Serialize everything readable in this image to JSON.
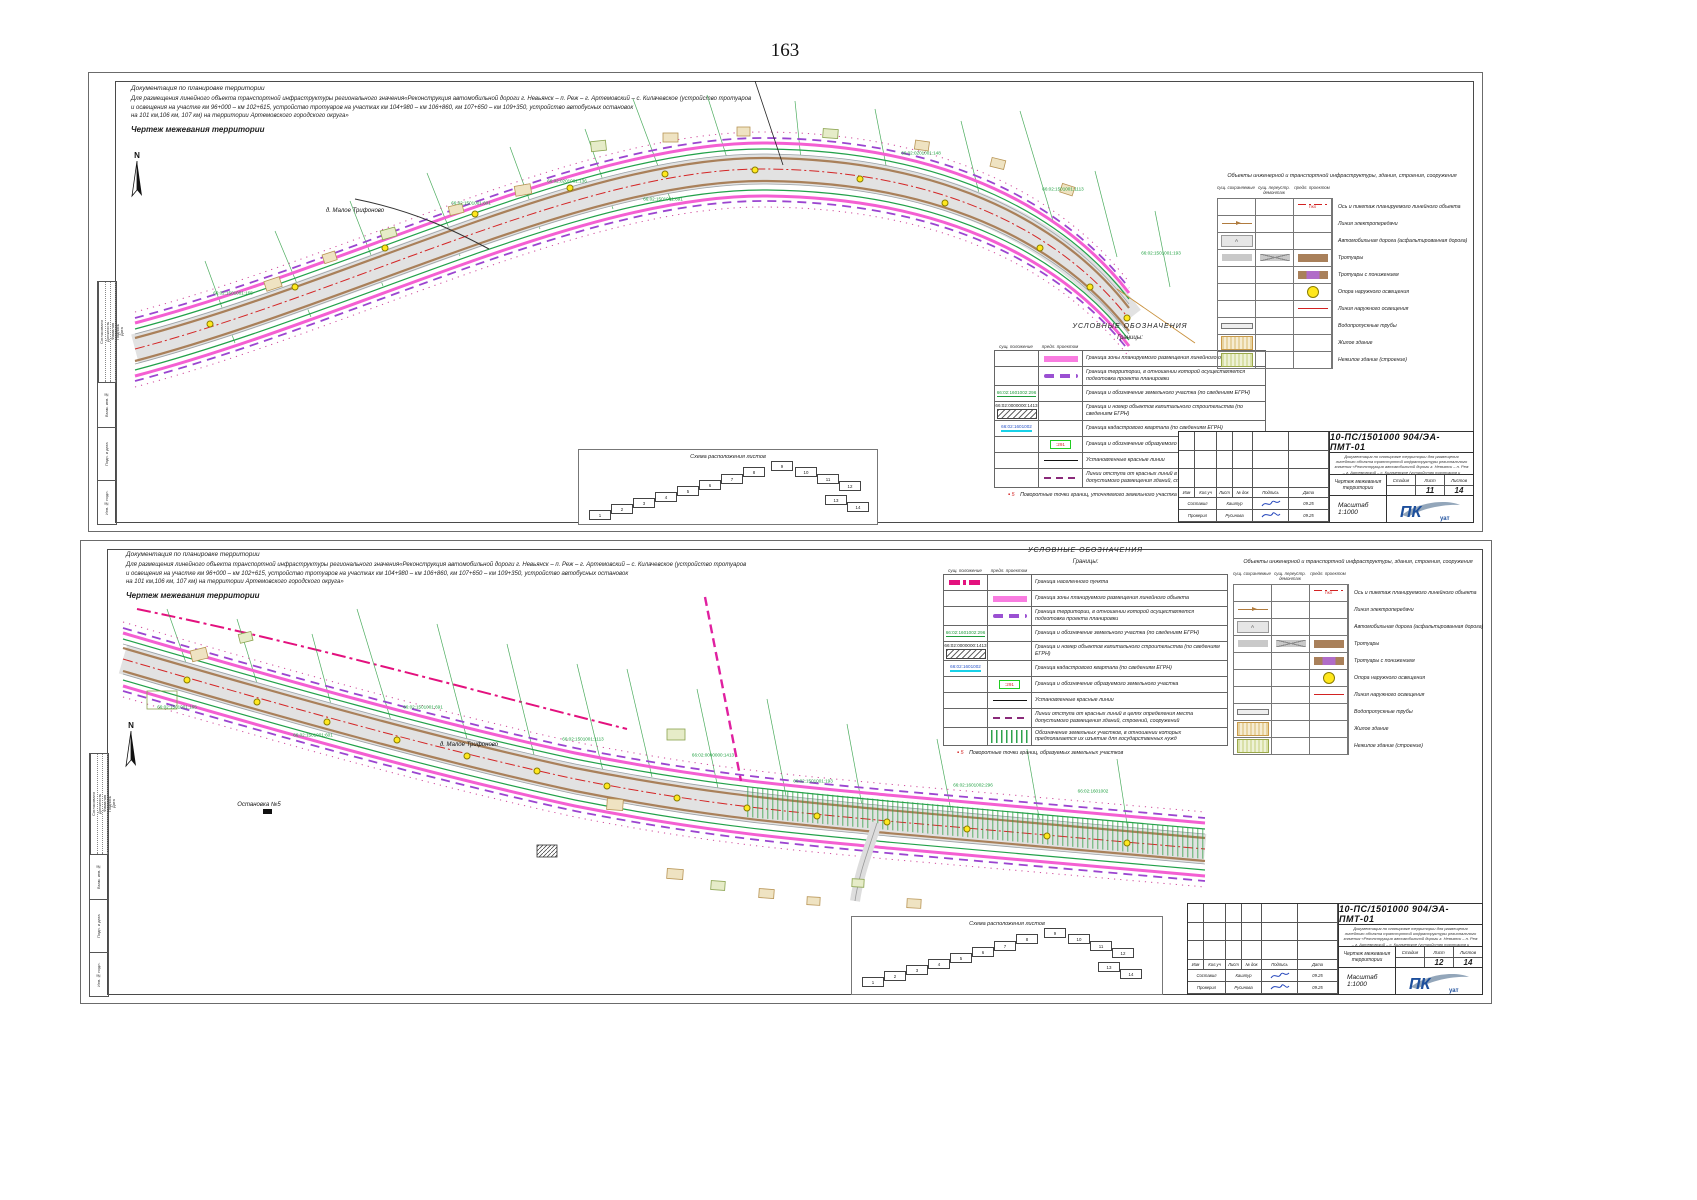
{
  "page": {
    "number": "163"
  },
  "header": {
    "doc_line1": "Документация по планировке территории",
    "doc_line2": "Для размещения линейного объекта транспортной инфраструктуры регионального значения«Реконструкция автомобильной дороги г. Невьянск – п. Реж – г. Артемовский – с. Килачевское (устройство тротуаров",
    "doc_line3": "и освещения на участке км 96+000 – км 102+615, устройство тротуаров на участках км 104+980 – км 106+860, км 107+650 – км 109+350, устройство автобусных остановок",
    "doc_line4": "на 101 км,106 км, 107 км) на территории Артемовского городского округа»",
    "sheet_title": "Чертеж межевания территории"
  },
  "north": {
    "label": "N"
  },
  "legend": {
    "title": "УСЛОВНЫЕ ОБОЗНАЧЕНИЯ",
    "group_title": "Границы:",
    "col1": "сущ. положение",
    "col2": "предл. проектом",
    "note_marker": "5",
    "note1": "Поворотные точки границ, уточняемого земельного участка",
    "note2": "Поворотные точки границ, образуемых земельных участков",
    "rows1": [
      {
        "c2": "cl-pink",
        "label": "Граница зоны планируемого размещения линейного объекта"
      },
      {
        "c2": "cl-pdash",
        "label": "Граница территории, в отношении которой осуществляется подготовка проекта планировки"
      },
      {
        "c1": "cl-cg",
        "c1t": "66:02:1601002:296",
        "label": "Граница и обозначение земельного участка (по сведениям ЕГРН)"
      },
      {
        "c1": "cl-oks",
        "c1t": "66:02:0000000:1413",
        "label": "Граница и номер объектов капитального строительства (по сведениям ЕГРН)"
      },
      {
        "c1": "cl-cc",
        "c1t": "66:02:1601002",
        "label": "Граница кадастрового квартала (по сведениям ЕГРН)"
      },
      {
        "c2": "cl-gbox",
        "c2t": ":291",
        "label": "Граница и обозначение образуемого земельного участка"
      },
      {
        "c2": "cl-red",
        "label": "Установленные красные линии"
      },
      {
        "c2": "cl-off",
        "label": "Линии отступа от красных линий в целях определения места допустимого размещения зданий, строений, сооружений"
      }
    ],
    "rows2": [
      {
        "c1": "cl-npdash",
        "label": "Граница населенного пункта"
      },
      {
        "c2": "cl-pink",
        "label": "Граница зоны планируемого размещения линейного объекта"
      },
      {
        "c2": "cl-pdash",
        "label": "Граница территории, в отношении которой осуществляется подготовка проекта планировки"
      },
      {
        "c1": "cl-cg",
        "c1t": "66:02:1601002:296",
        "label": "Граница и обозначение земельного участка (по сведениям ЕГРН)"
      },
      {
        "c1": "cl-oks",
        "c1t": "66:02:0000000:1413",
        "label": "Граница и номер объектов капитального строительства (по сведениям ЕГРН)"
      },
      {
        "c1": "cl-cc",
        "c1t": "66:02:1601002",
        "label": "Граница кадастрового квартала (по сведениям ЕГРН)"
      },
      {
        "c2": "cl-gbox",
        "c2t": ":291",
        "label": "Граница и обозначение образуемого земельного участка"
      },
      {
        "c2": "cl-red",
        "label": "Установленные красные линии"
      },
      {
        "c2": "cl-off",
        "label": "Линии отступа от красных линий в целях определения места допустимого размещения зданий, строений, сооружений"
      },
      {
        "c2": "cl-vh",
        "label": "Обозначение земельных участков, в отношении которых предполагается их изъятие для государственных нужд"
      }
    ]
  },
  "objects": {
    "title": "Объекты инженерной и транспортной инфраструктуры, здания, строения, сооружения",
    "col1": "сущ. сохраняемые",
    "col2": "сущ. переустр. демонтаж",
    "col3": "предл. проектом",
    "rows": [
      {
        "c3": "ob-axis",
        "c3t": "ПК0",
        "label": "Ось и пикетаж планируемого линейного объекта"
      },
      {
        "c1": "ob-pow",
        "label": "Линия электропередачи"
      },
      {
        "c1": "ob-road",
        "c1t": "А",
        "label": "Автомобильная дорога (асфальтированная дорога)"
      },
      {
        "c1": "ob-sw1",
        "c2": "ob-sw2",
        "c3": "ob-sw3",
        "label": "Тротуары"
      },
      {
        "c3": "ob-swl",
        "label": "Тротуары с понижением"
      },
      {
        "c3": "ob-lamp",
        "label": "Опора наружного освещения"
      },
      {
        "c3": "ob-light",
        "label": "Линия наружного освещения"
      },
      {
        "c1": "ob-pipe",
        "label": "Водопропускные трубы"
      },
      {
        "c1": "ob-house",
        "label": "Жилое здание"
      },
      {
        "c1": "ob-nres",
        "label": "Нежилое здание (строение)"
      }
    ]
  },
  "scheme": {
    "title": "Схема расположения листов",
    "boxes": [
      {
        "n": "1",
        "x": 10,
        "y": 60
      },
      {
        "n": "2",
        "x": 32,
        "y": 54
      },
      {
        "n": "3",
        "x": 54,
        "y": 48
      },
      {
        "n": "4",
        "x": 76,
        "y": 42
      },
      {
        "n": "5",
        "x": 98,
        "y": 36
      },
      {
        "n": "6",
        "x": 120,
        "y": 30
      },
      {
        "n": "7",
        "x": 142,
        "y": 24
      },
      {
        "n": "8",
        "x": 164,
        "y": 17
      },
      {
        "n": "9",
        "x": 192,
        "y": 11
      },
      {
        "n": "10",
        "x": 216,
        "y": 17
      },
      {
        "n": "11",
        "x": 238,
        "y": 24
      },
      {
        "n": "12",
        "x": 260,
        "y": 31
      },
      {
        "n": "13",
        "x": 246,
        "y": 45
      },
      {
        "n": "14",
        "x": 268,
        "y": 52
      }
    ]
  },
  "stamp": {
    "doc_number": "10-ПС/1501000 904/ЭА-ПМТ-01",
    "desc": "Документация по планировке территории для размещения линейного объекта транспортной инфраструктуры регионального значения «Реконструкция автомобильной дороги г. Невьянск – п. Реж – г. Артемовский – с. Килачевское (устройство тротуаров и освещения на участке км 96+000 – км 102+615, устройство тротуаров на участках км 104+980 – км 106+860, км 107+650 – км 109+350, устройство автобусных остановок на 101 км, 106 км, 107 км) на территории Артемовского городского округа»",
    "cols": [
      "Изм",
      "Кол.уч",
      "Лист",
      "№ док",
      "Подпись",
      "Дата"
    ],
    "row1_role": "Составил",
    "row1_name": "Каштур",
    "row1_date": "09.25",
    "row2_role": "Проверил",
    "row2_name": "Русинова",
    "row2_date": "09.25",
    "drawing_name": "Чертеж межевания территории",
    "stage_label": "Стадия",
    "sheet_label": "Лист",
    "sheets_label": "Листов",
    "scale": "Масштаб 1:1000",
    "logo": "ПК",
    "logo_sub": "уат",
    "accent_blue": "#1d4f9c"
  },
  "side": {
    "approve": "Согласовано",
    "c1": "Должность",
    "c2": "Фамилия",
    "c3": "Подпись",
    "c4": "Дата",
    "vzam": "Взам. инв.№",
    "podp": "Подп. и дата",
    "inv": "Инв.№ подл."
  },
  "sheet1": {
    "sheet_no": "11",
    "sheets_total": "14",
    "settlement": "д. Малое Трифоново",
    "map_labels": [
      {
        "t": "д. Малое Трифоново",
        "x": 240,
        "y": 130,
        "c": "ml-b"
      },
      {
        "t": "66:02:0201001:136",
        "x": 452,
        "y": 100,
        "c": "ml-g"
      },
      {
        "t": "66:02:1501001:601",
        "x": 356,
        "y": 122,
        "c": "ml-g"
      },
      {
        "t": "66:02:1501001:165",
        "x": 118,
        "y": 212,
        "c": "ml-g"
      },
      {
        "t": "66:02:1501001:691",
        "x": 548,
        "y": 118,
        "c": "ml-g"
      },
      {
        "t": "66:02:0201001:148",
        "x": 806,
        "y": 72,
        "c": "ml-g"
      },
      {
        "t": "66:02:1501001:1113",
        "x": 948,
        "y": 108,
        "c": "ml-g"
      },
      {
        "t": "66:02:1501001:193",
        "x": 1046,
        "y": 172,
        "c": "ml-g"
      }
    ],
    "lamps": [
      {
        "x": 95,
        "y": 243
      },
      {
        "x": 180,
        "y": 206
      },
      {
        "x": 270,
        "y": 167
      },
      {
        "x": 360,
        "y": 133
      },
      {
        "x": 455,
        "y": 107
      },
      {
        "x": 550,
        "y": 93
      },
      {
        "x": 640,
        "y": 89
      },
      {
        "x": 745,
        "y": 98
      },
      {
        "x": 830,
        "y": 122
      },
      {
        "x": 925,
        "y": 167
      },
      {
        "x": 975,
        "y": 206
      },
      {
        "x": 1012,
        "y": 237
      }
    ]
  },
  "sheet2": {
    "sheet_no": "12",
    "sheets_total": "14",
    "stop_label": "Остановка №5",
    "map_labels": [
      {
        "t": "д. Малое Трифоново",
        "x": 362,
        "y": 196,
        "c": "ml-b"
      },
      {
        "t": "Остановка №5",
        "x": 152,
        "y": 256,
        "c": "ml-b"
      },
      {
        "t": "66:02:1501001:165",
        "x": 70,
        "y": 158,
        "c": "ml-g"
      },
      {
        "t": "66:02:1501001:601",
        "x": 206,
        "y": 186,
        "c": "ml-g"
      },
      {
        "t": "66:02:1501001:691",
        "x": 316,
        "y": 158,
        "c": "ml-g"
      },
      {
        "t": "66:02:1501001:1113",
        "x": 476,
        "y": 190,
        "c": "ml-g"
      },
      {
        "t": "66:02:0000000:1413",
        "x": 606,
        "y": 206,
        "c": "ml-g"
      },
      {
        "t": "66:02:1501001:193",
        "x": 706,
        "y": 232,
        "c": "ml-g"
      },
      {
        "t": "66:02:1601002:296",
        "x": 866,
        "y": 236,
        "c": "ml-g"
      },
      {
        "t": "66:02:1601002",
        "x": 986,
        "y": 242,
        "c": "ml-g"
      }
    ],
    "lamps": [
      {
        "x": 80,
        "y": 131
      },
      {
        "x": 150,
        "y": 153
      },
      {
        "x": 220,
        "y": 173
      },
      {
        "x": 290,
        "y": 191
      },
      {
        "x": 360,
        "y": 207
      },
      {
        "x": 430,
        "y": 222
      },
      {
        "x": 500,
        "y": 237
      },
      {
        "x": 570,
        "y": 249
      },
      {
        "x": 640,
        "y": 259
      },
      {
        "x": 710,
        "y": 267
      },
      {
        "x": 780,
        "y": 273
      },
      {
        "x": 860,
        "y": 280
      },
      {
        "x": 940,
        "y": 287
      },
      {
        "x": 1020,
        "y": 294
      }
    ]
  }
}
